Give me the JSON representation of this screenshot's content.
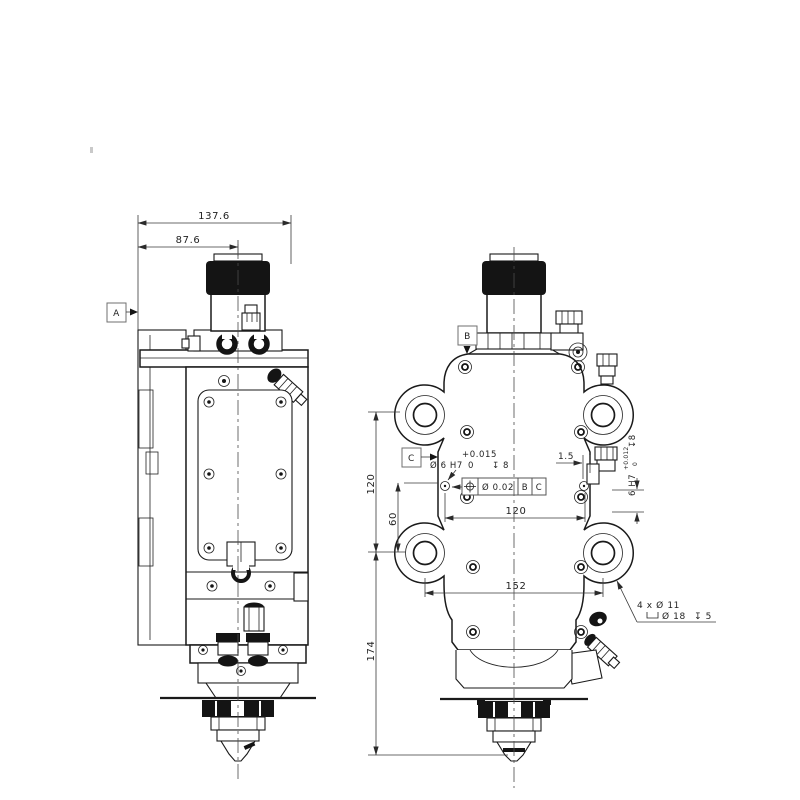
{
  "drawing": {
    "dimensions": {
      "overall_width": "137.6",
      "centerline_offset": "87.6",
      "lug_vertical_spacing": "120",
      "dowel_vertical_offset": "60",
      "nozzle_tip_distance": "174",
      "hole_horizontal_spacing": "120",
      "lug_horizontal_spacing": "152",
      "side_hole_offset": "1.5"
    },
    "datum_labels": {
      "a": "A",
      "b": "B",
      "c": "C"
    },
    "dowel_hole_callout": {
      "diameter": "Ø 6 H7",
      "tolerance_upper": "+0.015",
      "tolerance_lower": "0",
      "depth": "↧ 8"
    },
    "position_tolerance": {
      "value": "Ø 0.02",
      "datum_primary": "B",
      "datum_secondary": "C"
    },
    "side_hole_callout": {
      "size": "6 H7",
      "tolerance_upper": "+0.012",
      "tolerance_lower": "0",
      "depth": "↧8"
    },
    "mounting_hole_note": {
      "quantity_line": "4 x Ø 11",
      "counterbore_diameter": "Ø 18",
      "counterbore_depth": "↧ 5"
    }
  }
}
